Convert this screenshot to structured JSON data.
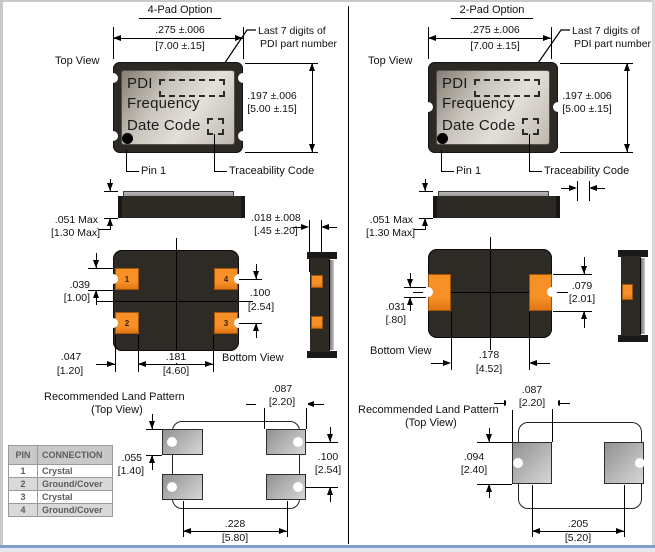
{
  "colors": {
    "accent_orange": "#f0851c",
    "package_body": "#2d2a26",
    "footer_bar": "#7c9fc9",
    "land_pad_gray": "#b8b8b8"
  },
  "left": {
    "title": "4-Pad Option",
    "top_view": "Top View",
    "bottom_view": "Bottom View",
    "dim_width_in": ".275 ±.006",
    "dim_width_mm": "[7.00 ±.15]",
    "dim_height_in": ".197 ±.006",
    "dim_height_mm": "[5.00 ±.15]",
    "dim_thick_in": ".051 Max",
    "dim_thick_mm": "[1.30 Max]",
    "dim_lid_in": ".018 ±.008",
    "dim_lid_mm": "[.45 ±.20]",
    "callout_line1": "Last 7 digits of",
    "callout_line2": "PDI part number",
    "pin1": "Pin 1",
    "traceability": "Traceability Code",
    "pkg_brand": "PDI",
    "pkg_freq": "Frequency",
    "pkg_date": "Date Code",
    "dim_pad_h_in": ".039",
    "dim_pad_h_mm": "[1.00]",
    "dim_pitch_v_in": ".100",
    "dim_pitch_v_mm": "[2.54]",
    "dim_pad_w_in": ".047",
    "dim_pad_w_mm": "[1.20]",
    "dim_pitch_h_in": ".181",
    "dim_pitch_h_mm": "[4.60]",
    "pad_numbers": [
      "1",
      "2",
      "3",
      "4"
    ],
    "land_title1": "Recommended Land Pattern",
    "land_title2": "(Top View)",
    "land_pad_w_in": ".087",
    "land_pad_w_mm": "[2.20]",
    "land_pad_h_in": ".055",
    "land_pad_h_mm": "[1.40]",
    "land_pitch_v_in": ".100",
    "land_pitch_v_mm": "[2.54]",
    "land_pitch_h_in": ".228",
    "land_pitch_h_mm": "[5.80]"
  },
  "right": {
    "title": "2-Pad Option",
    "top_view": "Top View",
    "bottom_view": "Bottom View",
    "dim_width_in": ".275 ±.006",
    "dim_width_mm": "[7.00 ±.15]",
    "dim_height_in": ".197 ±.006",
    "dim_height_mm": "[5.00 ±.15]",
    "dim_thick_in": ".051 Max",
    "dim_thick_mm": "[1.30 Max]",
    "callout_line1": "Last 7 digits of",
    "callout_line2": "PDI part number",
    "pin1": "Pin 1",
    "traceability": "Traceability Code",
    "pkg_brand": "PDI",
    "pkg_freq": "Frequency",
    "pkg_date": "Date Code",
    "dim_notch_in": ".031",
    "dim_notch_mm": "[.80]",
    "dim_pad_h_in": ".079",
    "dim_pad_h_mm": "[2.01]",
    "dim_pitch_h_in": ".178",
    "dim_pitch_h_mm": "[4.52]",
    "land_title1": "Recommended Land Pattern",
    "land_title2": "(Top View)",
    "land_pad_w_in": ".087",
    "land_pad_w_mm": "[2.20]",
    "land_pad_h_in": ".094",
    "land_pad_h_mm": "[2.40]",
    "land_pitch_h_in": ".205",
    "land_pitch_h_mm": "[5.20]"
  },
  "pin_table": {
    "headers": [
      "PIN",
      "CONNECTION"
    ],
    "rows": [
      [
        "1",
        "Crystal"
      ],
      [
        "2",
        "Ground/Cover"
      ],
      [
        "3",
        "Crystal"
      ],
      [
        "4",
        "Ground/Cover"
      ]
    ]
  }
}
